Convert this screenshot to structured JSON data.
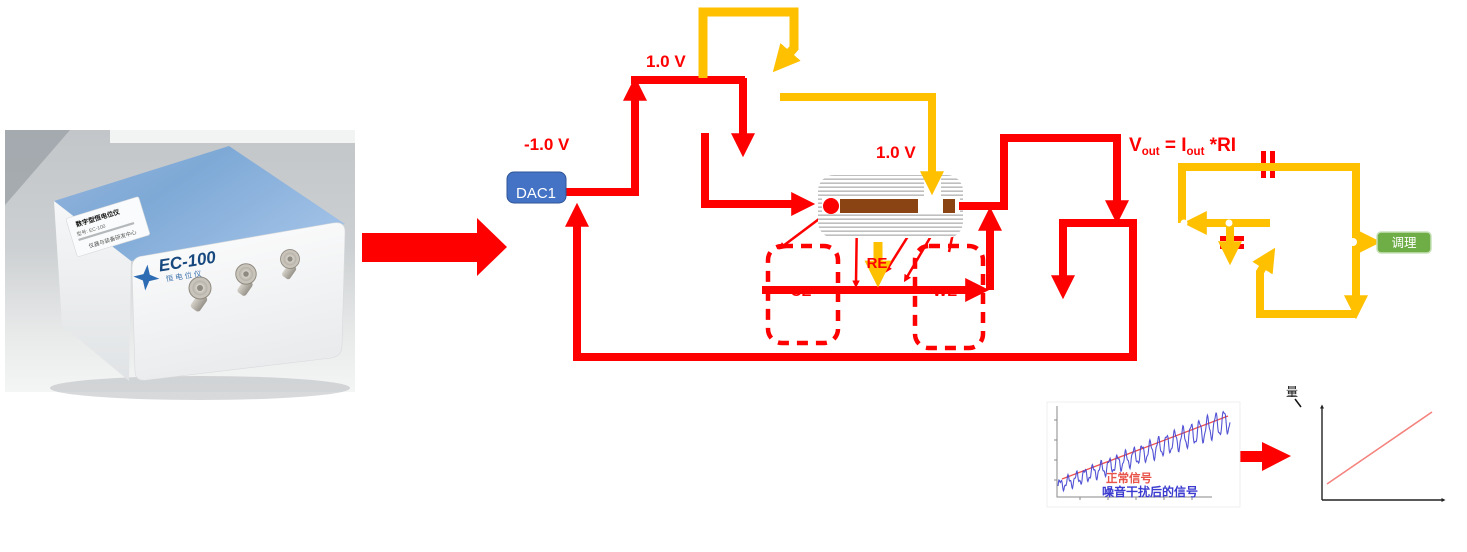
{
  "device_photo": {
    "brand": "EC-100",
    "brand_subtitle": "恒电位仪",
    "sticker_title": "数字型恒电位仪",
    "sticker_line2": "型号: EC-100",
    "sticker_footer": "仪器与装备研发中心"
  },
  "diagram": {
    "dac_label": "DAC1",
    "neg_voltage": "-1.0 V",
    "pos_voltage_top": "1.0 V",
    "pos_voltage_cell": "1.0 V",
    "label_ce": "CE",
    "label_re": "RE",
    "label_we": "WE",
    "formula": {
      "p1": "V",
      "s1": "out",
      "p2": " = I",
      "s2": "out",
      "p3": " *RI"
    },
    "conditioning_label": "调理",
    "colors": {
      "signal_red": "#FE0000",
      "sense_yellow": "#FFC000",
      "dac_blue": "#4472C4",
      "conditioning_green": "#6FAD47",
      "electrode_brown": "#8A4413"
    }
  },
  "plots": {
    "noisy_plot": {
      "label_normal": "正常信号",
      "label_noisy": "噪音干扰后的信号",
      "normal_color": "#E8534A",
      "noisy_color": "#4040D0",
      "wave": {
        "points": 380,
        "cycles": 21,
        "amp_start": 5,
        "amp_end": 12,
        "rise": 66
      }
    },
    "linear_plot": {
      "axis_label": "量",
      "line_color": "#F4827D"
    }
  }
}
